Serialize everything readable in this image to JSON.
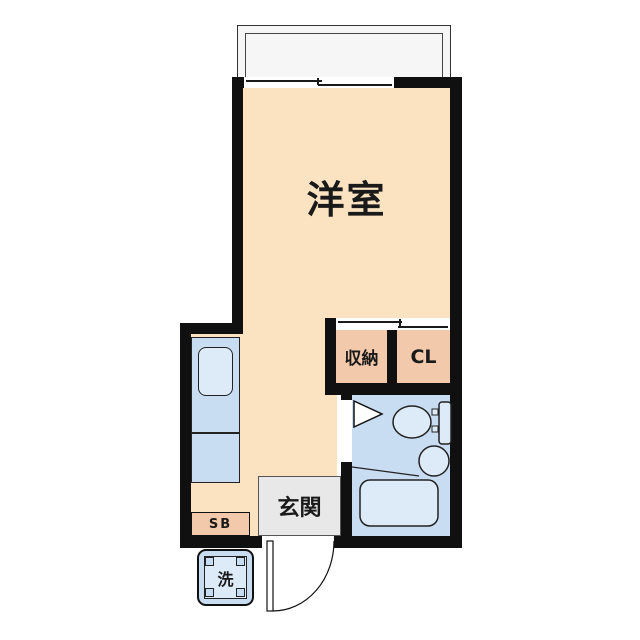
{
  "plan_title": "studio-apartment-floor-plan",
  "colors": {
    "wall": "#101010",
    "line": "#1a1a1a",
    "room_floor": "#FBE3C2",
    "closet_fill": "#F2C9AB",
    "water_fill": "#C9DDF2",
    "fixture_fill": "#DDEAF8",
    "entrance_fill": "#E8E8E8",
    "balcony_fill": "#F6F6F7"
  },
  "rooms": {
    "main_room": {
      "label": "洋室"
    },
    "storage": {
      "label": "収納"
    },
    "closet": {
      "label": "CL"
    },
    "entrance": {
      "label": "玄関"
    },
    "shoe_box": {
      "label": "SB"
    },
    "washer": {
      "label": "洗"
    }
  }
}
